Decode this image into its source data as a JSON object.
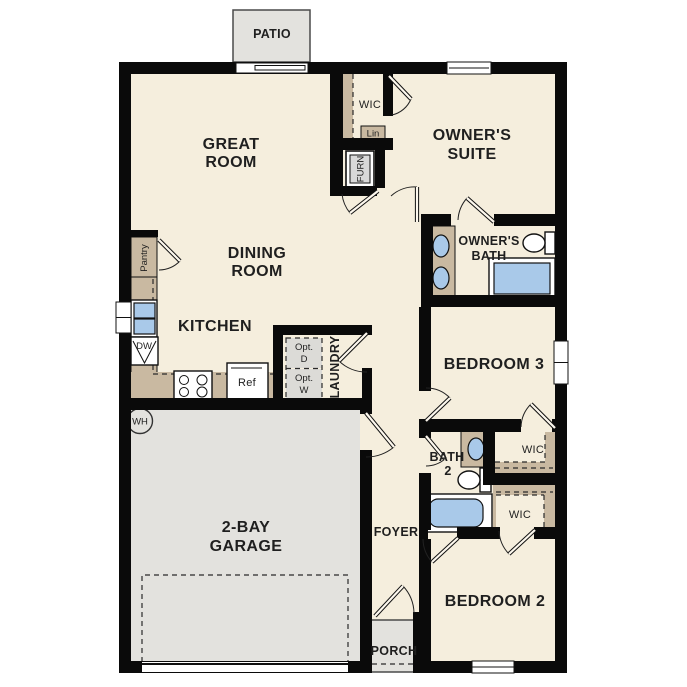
{
  "title": "Single-story house floor plan",
  "colors": {
    "wall": "#0a0a0a",
    "floor": "#f5eedd",
    "outdoor": "#e3e2de",
    "tan": "#c9b9a1",
    "blue": "#a9c9e9",
    "dash": "#2a2a2a",
    "fixture_gray": "#d9d9d9",
    "text": "#1f1f1f"
  },
  "rooms": {
    "patio": {
      "label": "PATIO"
    },
    "great_room": {
      "l1": "GREAT",
      "l2": "ROOM"
    },
    "dining_room": {
      "l1": "DINING",
      "l2": "ROOM"
    },
    "kitchen": {
      "label": "KITCHEN"
    },
    "owners_suite": {
      "l1": "OWNER'S",
      "l2": "SUITE"
    },
    "owners_bath": {
      "l1": "OWNER'S",
      "l2": "BATH"
    },
    "owners_wic": {
      "label": "WIC"
    },
    "linen": {
      "label": "Lin"
    },
    "furnace": {
      "label": "FURN"
    },
    "pantry": {
      "label": "Pantry"
    },
    "laundry": {
      "label": "LAUNDRY"
    },
    "bedroom3": {
      "label": "BEDROOM 3"
    },
    "bedroom3_wic": {
      "label": "WIC"
    },
    "bath2": {
      "l1": "BATH",
      "l2": "2"
    },
    "bedroom2": {
      "label": "BEDROOM 2"
    },
    "bedroom2_wic": {
      "label": "WIC"
    },
    "garage": {
      "l1": "2-BAY",
      "l2": "GARAGE"
    },
    "foyer": {
      "label": "FOYER"
    },
    "porch": {
      "label": "PORCH"
    }
  },
  "fixtures": {
    "water_heater": {
      "label": "WH"
    },
    "dishwasher": {
      "label": "DW"
    },
    "refrigerator": {
      "label": "Ref"
    },
    "opt_dryer": {
      "l1": "Opt.",
      "l2": "D"
    },
    "opt_washer": {
      "l1": "Opt.",
      "l2": "W"
    }
  }
}
